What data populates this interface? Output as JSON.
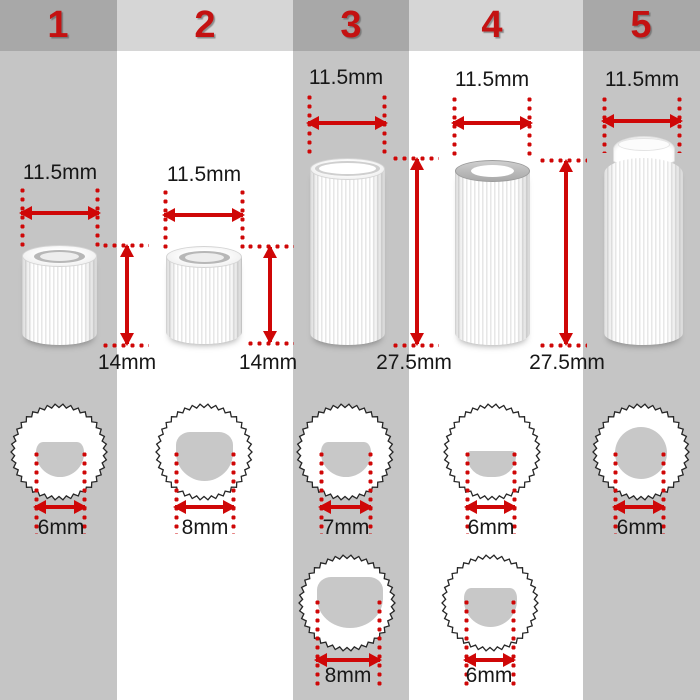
{
  "palette": {
    "accent_red": "#cf0707",
    "number_red": "#c41212",
    "header_dark_gray": "#a8a8a8",
    "header_light_gray": "#d6d6d6",
    "body_gray": "#c5c5c5",
    "body_white": "#ffffff",
    "hole_gray": "#c8c8c8",
    "outline_black": "#262626",
    "text_black": "#171717"
  },
  "columns": [
    {
      "number": "1",
      "width_label": "11.5mm",
      "height_label": "14mm",
      "hole_labels": [
        "6mm"
      ]
    },
    {
      "number": "2",
      "width_label": "11.5mm",
      "height_label": "14mm",
      "hole_labels": [
        "8mm"
      ]
    },
    {
      "number": "3",
      "width_label": "11.5mm",
      "height_label": "27.5mm",
      "hole_labels": [
        "7mm",
        "8mm"
      ]
    },
    {
      "number": "4",
      "width_label": "11.5mm",
      "height_label": "27.5mm",
      "hole_labels": [
        "6mm",
        "6mm"
      ]
    },
    {
      "number": "5",
      "width_label": "11.5mm",
      "height_label": "",
      "hole_labels": [
        "6mm"
      ]
    }
  ]
}
